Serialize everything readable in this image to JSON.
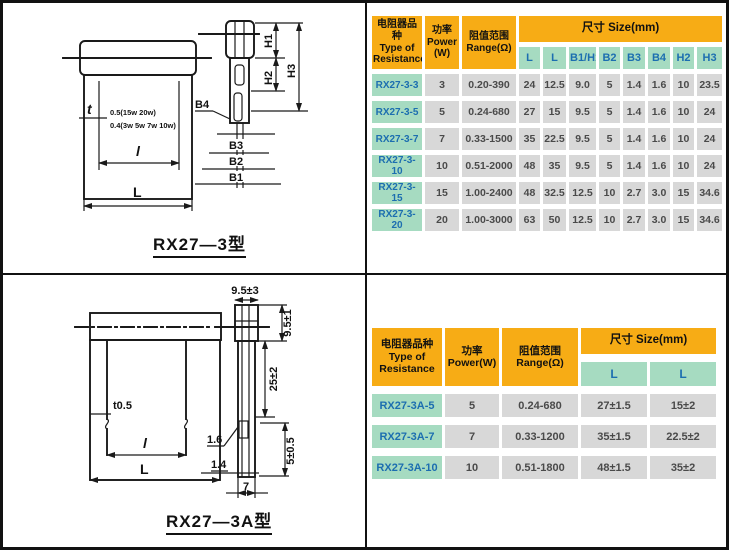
{
  "colors": {
    "header_orange": "#F7AC15",
    "label_green": "#A6DBC1",
    "cell_gray": "#D8D8D8",
    "text_blue": "#1C6EB0"
  },
  "top_section": {
    "drawing": {
      "caption": "RX27—3型",
      "labels": {
        "t": "t",
        "note1": "0.5(15w 20w)",
        "note2": "0.4(3w 5w 7w 10w)",
        "l": "l",
        "L": "L",
        "B4": "B4",
        "B3": "B3",
        "B2": "B2",
        "B1": "B1",
        "H1": "H1",
        "H2": "H2",
        "H3": "H3"
      }
    },
    "table": {
      "header": {
        "type": "电阻器品种\nType of\nResistance",
        "power": "功率\nPower\n(W)",
        "range": "阻值范围\nRange(Ω)",
        "size": "尺寸  Size(mm)",
        "size_cols": [
          "L",
          "L",
          "B1/H1",
          "B2",
          "B3",
          "B4",
          "H2",
          "H3"
        ]
      },
      "rows": [
        [
          "RX27-3-3",
          "3",
          "0.20-390",
          "24",
          "12.5",
          "9.0",
          "5",
          "1.4",
          "1.6",
          "10",
          "23.5"
        ],
        [
          "RX27-3-5",
          "5",
          "0.24-680",
          "27",
          "15",
          "9.5",
          "5",
          "1.4",
          "1.6",
          "10",
          "24"
        ],
        [
          "RX27-3-7",
          "7",
          "0.33-1500",
          "35",
          "22.5",
          "9.5",
          "5",
          "1.4",
          "1.6",
          "10",
          "24"
        ],
        [
          "RX27-3-10",
          "10",
          "0.51-2000",
          "48",
          "35",
          "9.5",
          "5",
          "1.4",
          "1.6",
          "10",
          "24"
        ],
        [
          "RX27-3-15",
          "15",
          "1.00-2400",
          "48",
          "32.5",
          "12.5",
          "10",
          "2.7",
          "3.0",
          "15",
          "34.6"
        ],
        [
          "RX27-3-20",
          "20",
          "1.00-3000",
          "63",
          "50",
          "12.5",
          "10",
          "2.7",
          "3.0",
          "15",
          "34.6"
        ]
      ]
    }
  },
  "bottom_section": {
    "drawing": {
      "caption": "RX27—3A型",
      "labels": {
        "top_width": "9.5±3",
        "cap_height": "9.5±1",
        "body_length": "25±2",
        "t": "t0.5",
        "l": "l",
        "L": "L",
        "lead1": "1.6",
        "lead2": "1.4",
        "bottom_width": "7",
        "tab": "5±0.5"
      }
    },
    "table": {
      "header": {
        "type": "电阻器品种\nType of\nResistance",
        "power": "功率\nPower(W)",
        "range": "阻值范围\nRange(Ω)",
        "size": "尺寸  Size(mm)",
        "size_cols": [
          "L",
          "L"
        ]
      },
      "rows": [
        [
          "RX27-3A-5",
          "5",
          "0.24-680",
          "27±1.5",
          "15±2"
        ],
        [
          "RX27-3A-7",
          "7",
          "0.33-1200",
          "35±1.5",
          "22.5±2"
        ],
        [
          "RX27-3A-10",
          "10",
          "0.51-1800",
          "48±1.5",
          "35±2"
        ]
      ]
    }
  }
}
